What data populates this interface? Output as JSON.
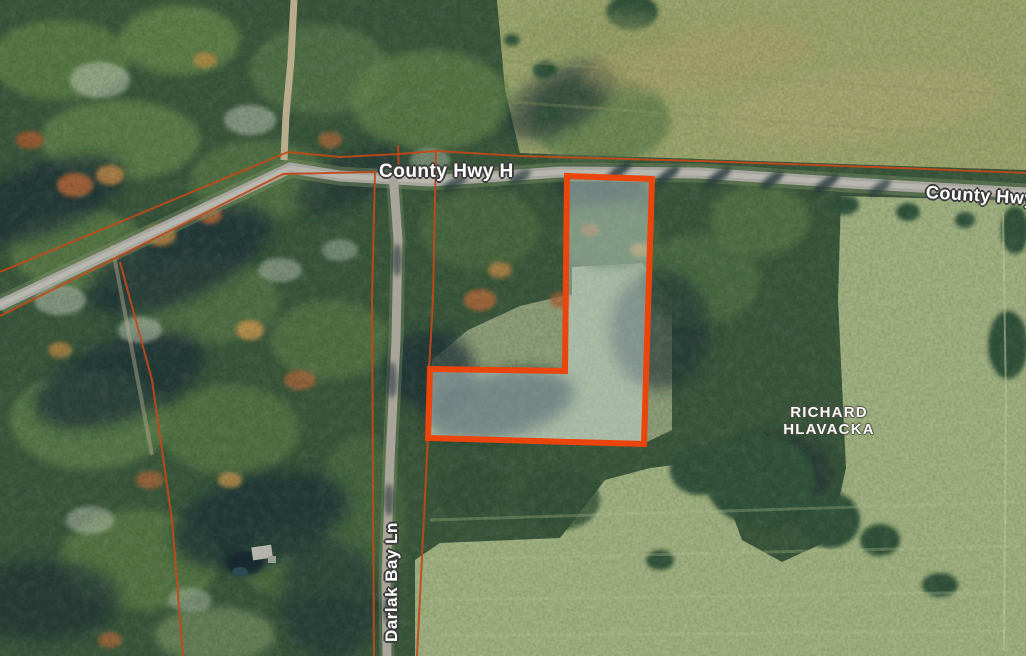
{
  "map": {
    "view": "aerial-imagery-parcel-viewer",
    "labels": {
      "hwy_center": "County Hwy H",
      "hwy_right": "County Hwy H",
      "darlak": "Darlak Bay Ln",
      "owner_line1": "RICHARD",
      "owner_line2": "HLAVACKA"
    },
    "colors": {
      "highlight_stroke": "#EA450D",
      "highlight_fill": "rgba(212,232,232,0.42)",
      "parcel_line": "#C2491A",
      "road": "#A6A69E",
      "road_center": "#BBBBB3",
      "trail": "#B9AC8D",
      "label_text": "#FFFFFF",
      "label_halo": "#3A3A3A"
    },
    "geometry": {
      "highlight_parcel": "567,176 652,179 644,444 428,438 430,369 565,371",
      "road_county_hwy": "0,305 290,168 340,176 430,181 560,172 700,173 850,183 1026,193",
      "road_darlak": "393,172 398,240 396,340 390,460 386,580 387,656",
      "trail_north": "294,0 291,60 286,115 284,160",
      "line_hwy_north": "0,272 288,152 340,157 398,154 437,151 520,156 700,161 900,168 1026,173",
      "line_hwy_cross": "398,145 399,176",
      "line_west": "0,316 283,174 375,172 372,300 374,656",
      "line_darlak_east": "436,152 433,300 429,370 428,437 417,656",
      "line_forest": "120,262 152,380 172,520 183,656"
    }
  }
}
